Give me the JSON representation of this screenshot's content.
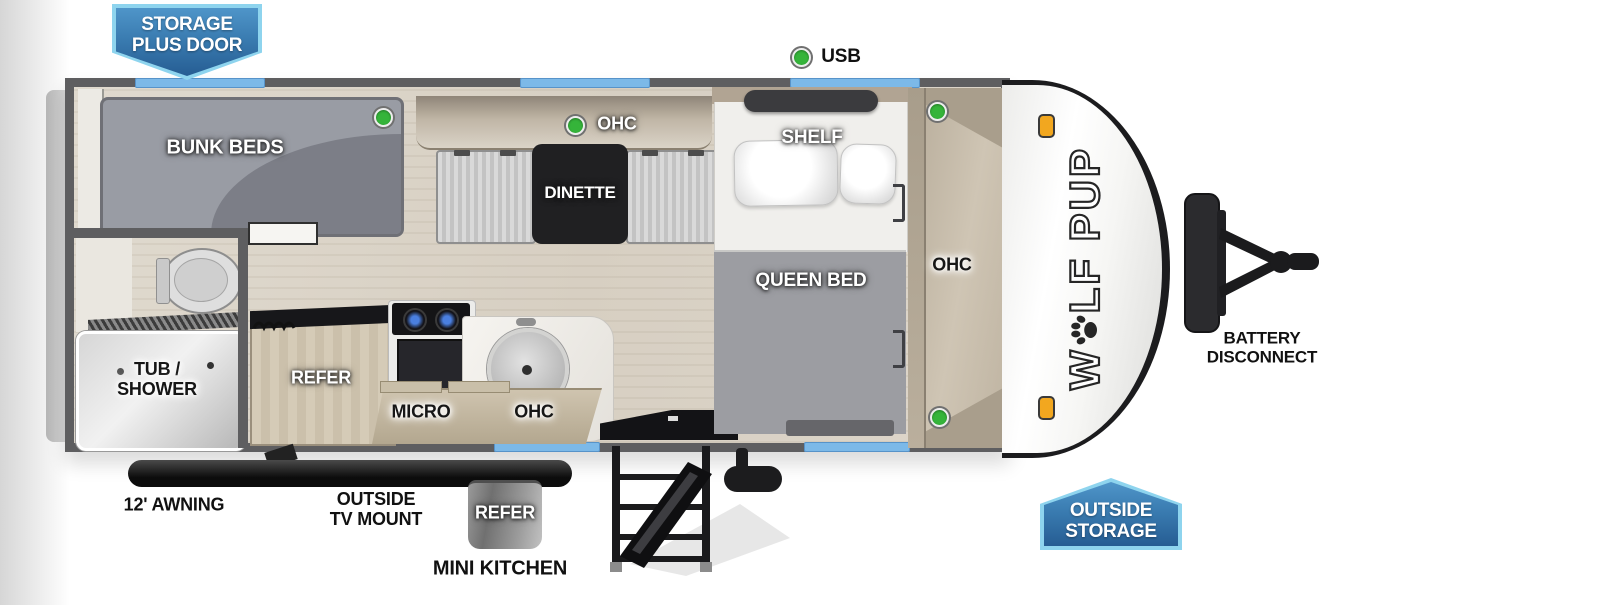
{
  "badges": {
    "storage_plus_door": {
      "line1": "STORAGE",
      "line2": "PLUS DOOR"
    },
    "outside_storage": {
      "line1": "OUTSIDE",
      "line2": "STORAGE"
    }
  },
  "exterior": {
    "usb_label": "USB",
    "battery_line1": "BATTERY",
    "battery_line2": "DISCONNECT",
    "awning_label": "12' AWNING",
    "tv_mount_line1": "OUTSIDE",
    "tv_mount_line2": "TV MOUNT",
    "outside_refer_label": "REFER",
    "mini_kitchen_label": "MINI KITCHEN"
  },
  "interior": {
    "bunk_beds": "BUNK BEDS",
    "dinette": "DINETTE",
    "dinette_ohc": "OHC",
    "shelf": "SHELF",
    "queen_bed": "QUEEN BED",
    "bedroom_ohc": "OHC",
    "kitchen_ohc": "OHC",
    "micro": "MICRO",
    "refer": "REFER",
    "tub_line1": "TUB /",
    "tub_line2": "SHOWER"
  },
  "brand": {
    "pre": "W",
    "post": "LF PUP"
  },
  "colors": {
    "badge_blue_dark": "#265d93",
    "badge_blue_light": "#4f95c9",
    "badge_border": "#8ed4ee",
    "window_blue": "#7cb9e8",
    "green_dot": "#35b43a",
    "wall_gray": "#5e5e60",
    "floor_wood": "#dbd4c8"
  }
}
